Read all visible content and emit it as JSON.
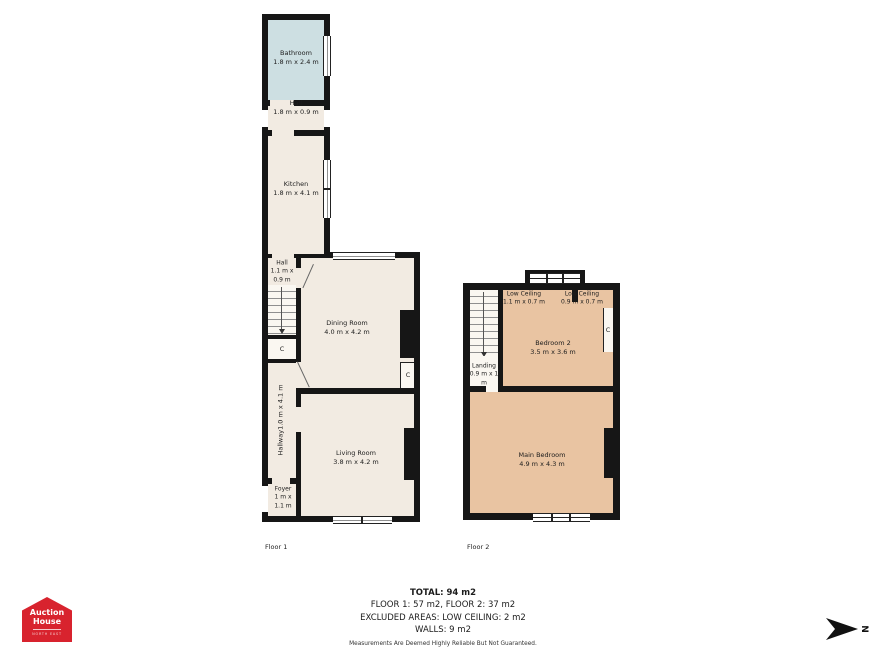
{
  "floor1": {
    "caption": "Floor 1",
    "rooms": {
      "bathroom": {
        "name": "Bathroom",
        "dims": "1.8 m x 2.4 m"
      },
      "hall_top": {
        "name": "Hall",
        "dims": "1.8 m x 0.9 m"
      },
      "kitchen": {
        "name": "Kitchen",
        "dims": "1.8 m x 4.1 m"
      },
      "hall_stairs": {
        "name": "Hall",
        "dims": "1.1 m x\n0.9 m"
      },
      "dining": {
        "name": "Dining Room",
        "dims": "4.0 m x 4.2 m"
      },
      "hallway": {
        "name": "Hallway",
        "dims": "1.0 m x 4.1 m"
      },
      "living": {
        "name": "Living Room",
        "dims": "3.8 m x 4.2 m"
      },
      "foyer": {
        "name": "Foyer",
        "dims": "1 m x\n1.1 m"
      },
      "cupboard_stairs": {
        "name": "C"
      },
      "cupboard_dining": {
        "name": "C"
      }
    }
  },
  "floor2": {
    "caption": "Floor 2",
    "rooms": {
      "low_ceiling_left": {
        "name": "Low Ceiling",
        "dims": "1.1 m x 0.7 m"
      },
      "low_ceiling_right": {
        "name": "Low Ceiling",
        "dims": "0.9 m x 0.7 m"
      },
      "bedroom2": {
        "name": "Bedroom 2",
        "dims": "3.5 m x 3.6 m"
      },
      "landing": {
        "name": "Landing",
        "dims": "0.9 m x 1\nm"
      },
      "main_bedroom": {
        "name": "Main Bedroom",
        "dims": "4.9 m x 4.3 m"
      },
      "cupboard": {
        "name": "C"
      }
    }
  },
  "summary": {
    "total": "TOTAL: 94 m2",
    "floors": "FLOOR 1: 57 m2, FLOOR 2: 37 m2",
    "excluded": "EXCLUDED AREAS: LOW CEILING: 2 m2",
    "walls": "WALLS: 9 m2",
    "disclaimer": "Measurements Are Deemed Highly Reliable But Not Guaranteed."
  },
  "logo": {
    "line1": "Auction",
    "line2": "House",
    "region": "NORTH EAST"
  },
  "compass": {
    "label": "N"
  },
  "colors": {
    "wall": "#161616",
    "floor_cream": "#f2ebe2",
    "bathroom_blue": "#cddfe2",
    "bedroom_peach": "#e9c4a2",
    "stairs_white": "#faf7f1",
    "logo_red": "#d8232e"
  }
}
